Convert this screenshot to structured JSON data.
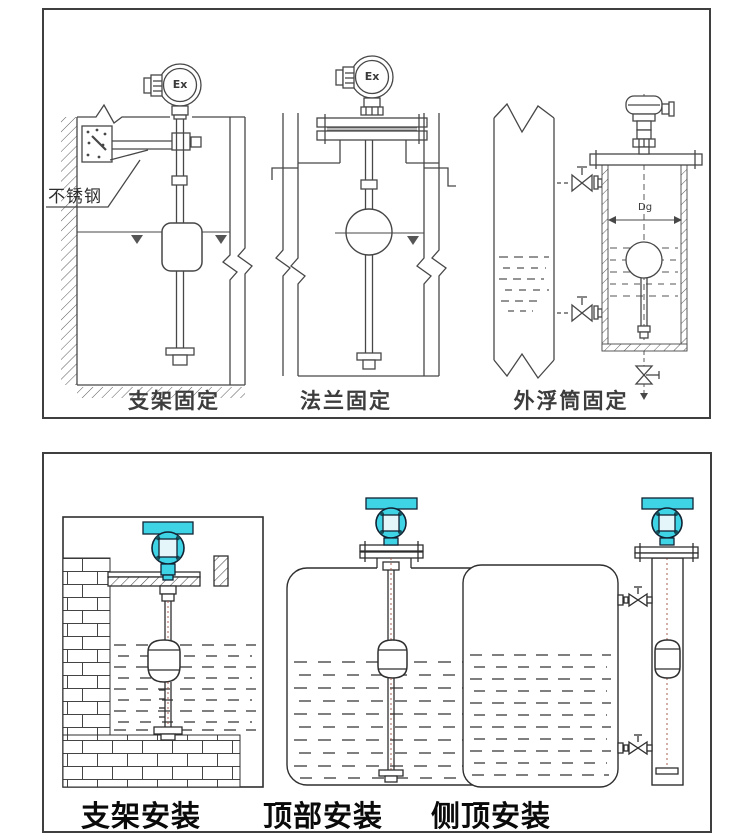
{
  "top_panel": {
    "captions": [
      "支架固定",
      "法兰固定",
      "外浮筒固定"
    ],
    "annotations": {
      "stainless_steel": "不锈钢",
      "ex": "Ex",
      "dg": "Dg"
    }
  },
  "bottom_panel": {
    "captions": [
      "支架安装",
      "顶部安装",
      "侧顶安装"
    ]
  },
  "colors": {
    "line": "#4a4a4a",
    "panel_border": "#3f3f3f",
    "transmitter_cyan": "#3fd3e6",
    "transmitter_display": "#e4f6fa",
    "caption_top": "#3d3d3d",
    "caption_bottom": "#0a0a0a",
    "liquid_dash": "#555555",
    "stem_dot": "#a05040"
  }
}
